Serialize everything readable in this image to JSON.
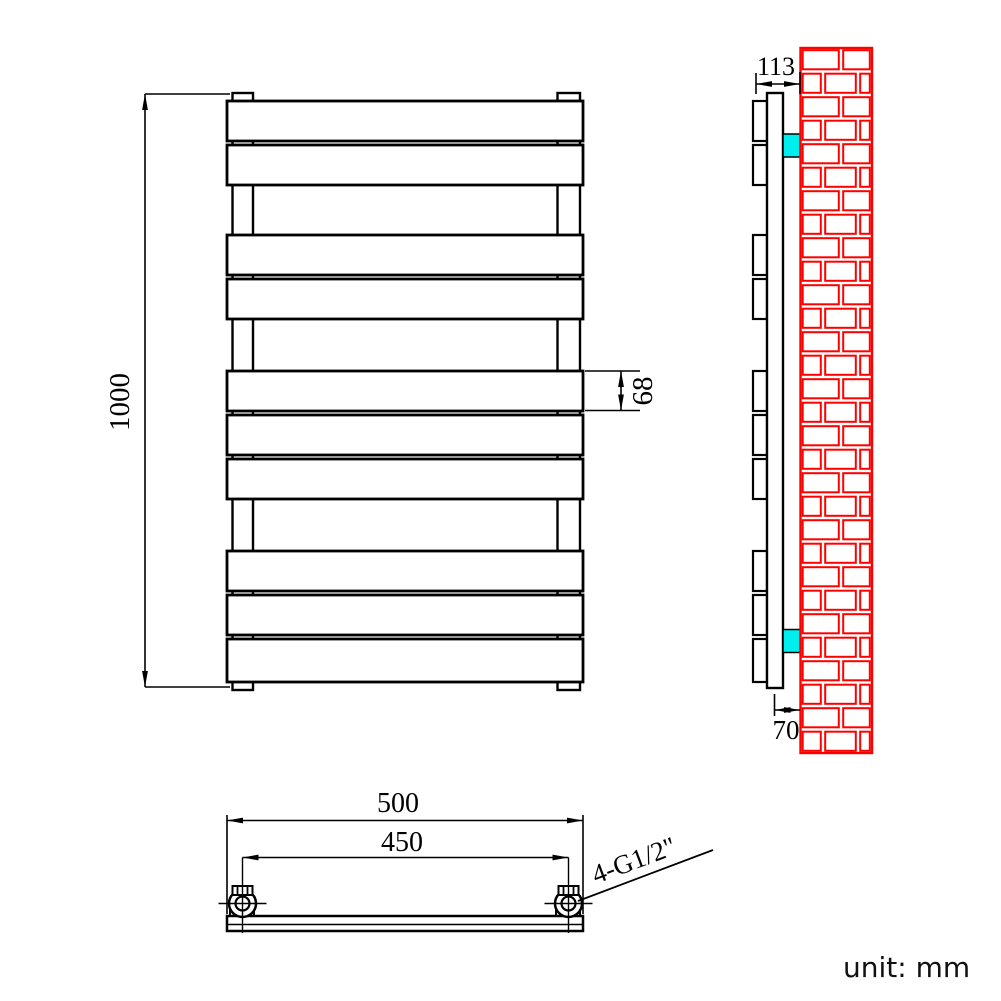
{
  "drawing": {
    "unit_note": "unit: mm",
    "dimensions": {
      "overall_height": "1000",
      "panel_height": "68",
      "overall_depth": "113",
      "wall_to_pipe_center": "70",
      "overall_width": "500",
      "connection_centers": "450",
      "connection_thread": "4-G1/2\""
    },
    "front_view": {
      "panel_groups": [
        2,
        2,
        3,
        3
      ],
      "panel_count": 10
    },
    "side_view": {
      "bracket_count": 2,
      "brick_rows": 30
    },
    "colors": {
      "outline": "#000000",
      "wall_brick": "#ff0000",
      "bracket": "#00eeee",
      "background": "#ffffff"
    }
  }
}
